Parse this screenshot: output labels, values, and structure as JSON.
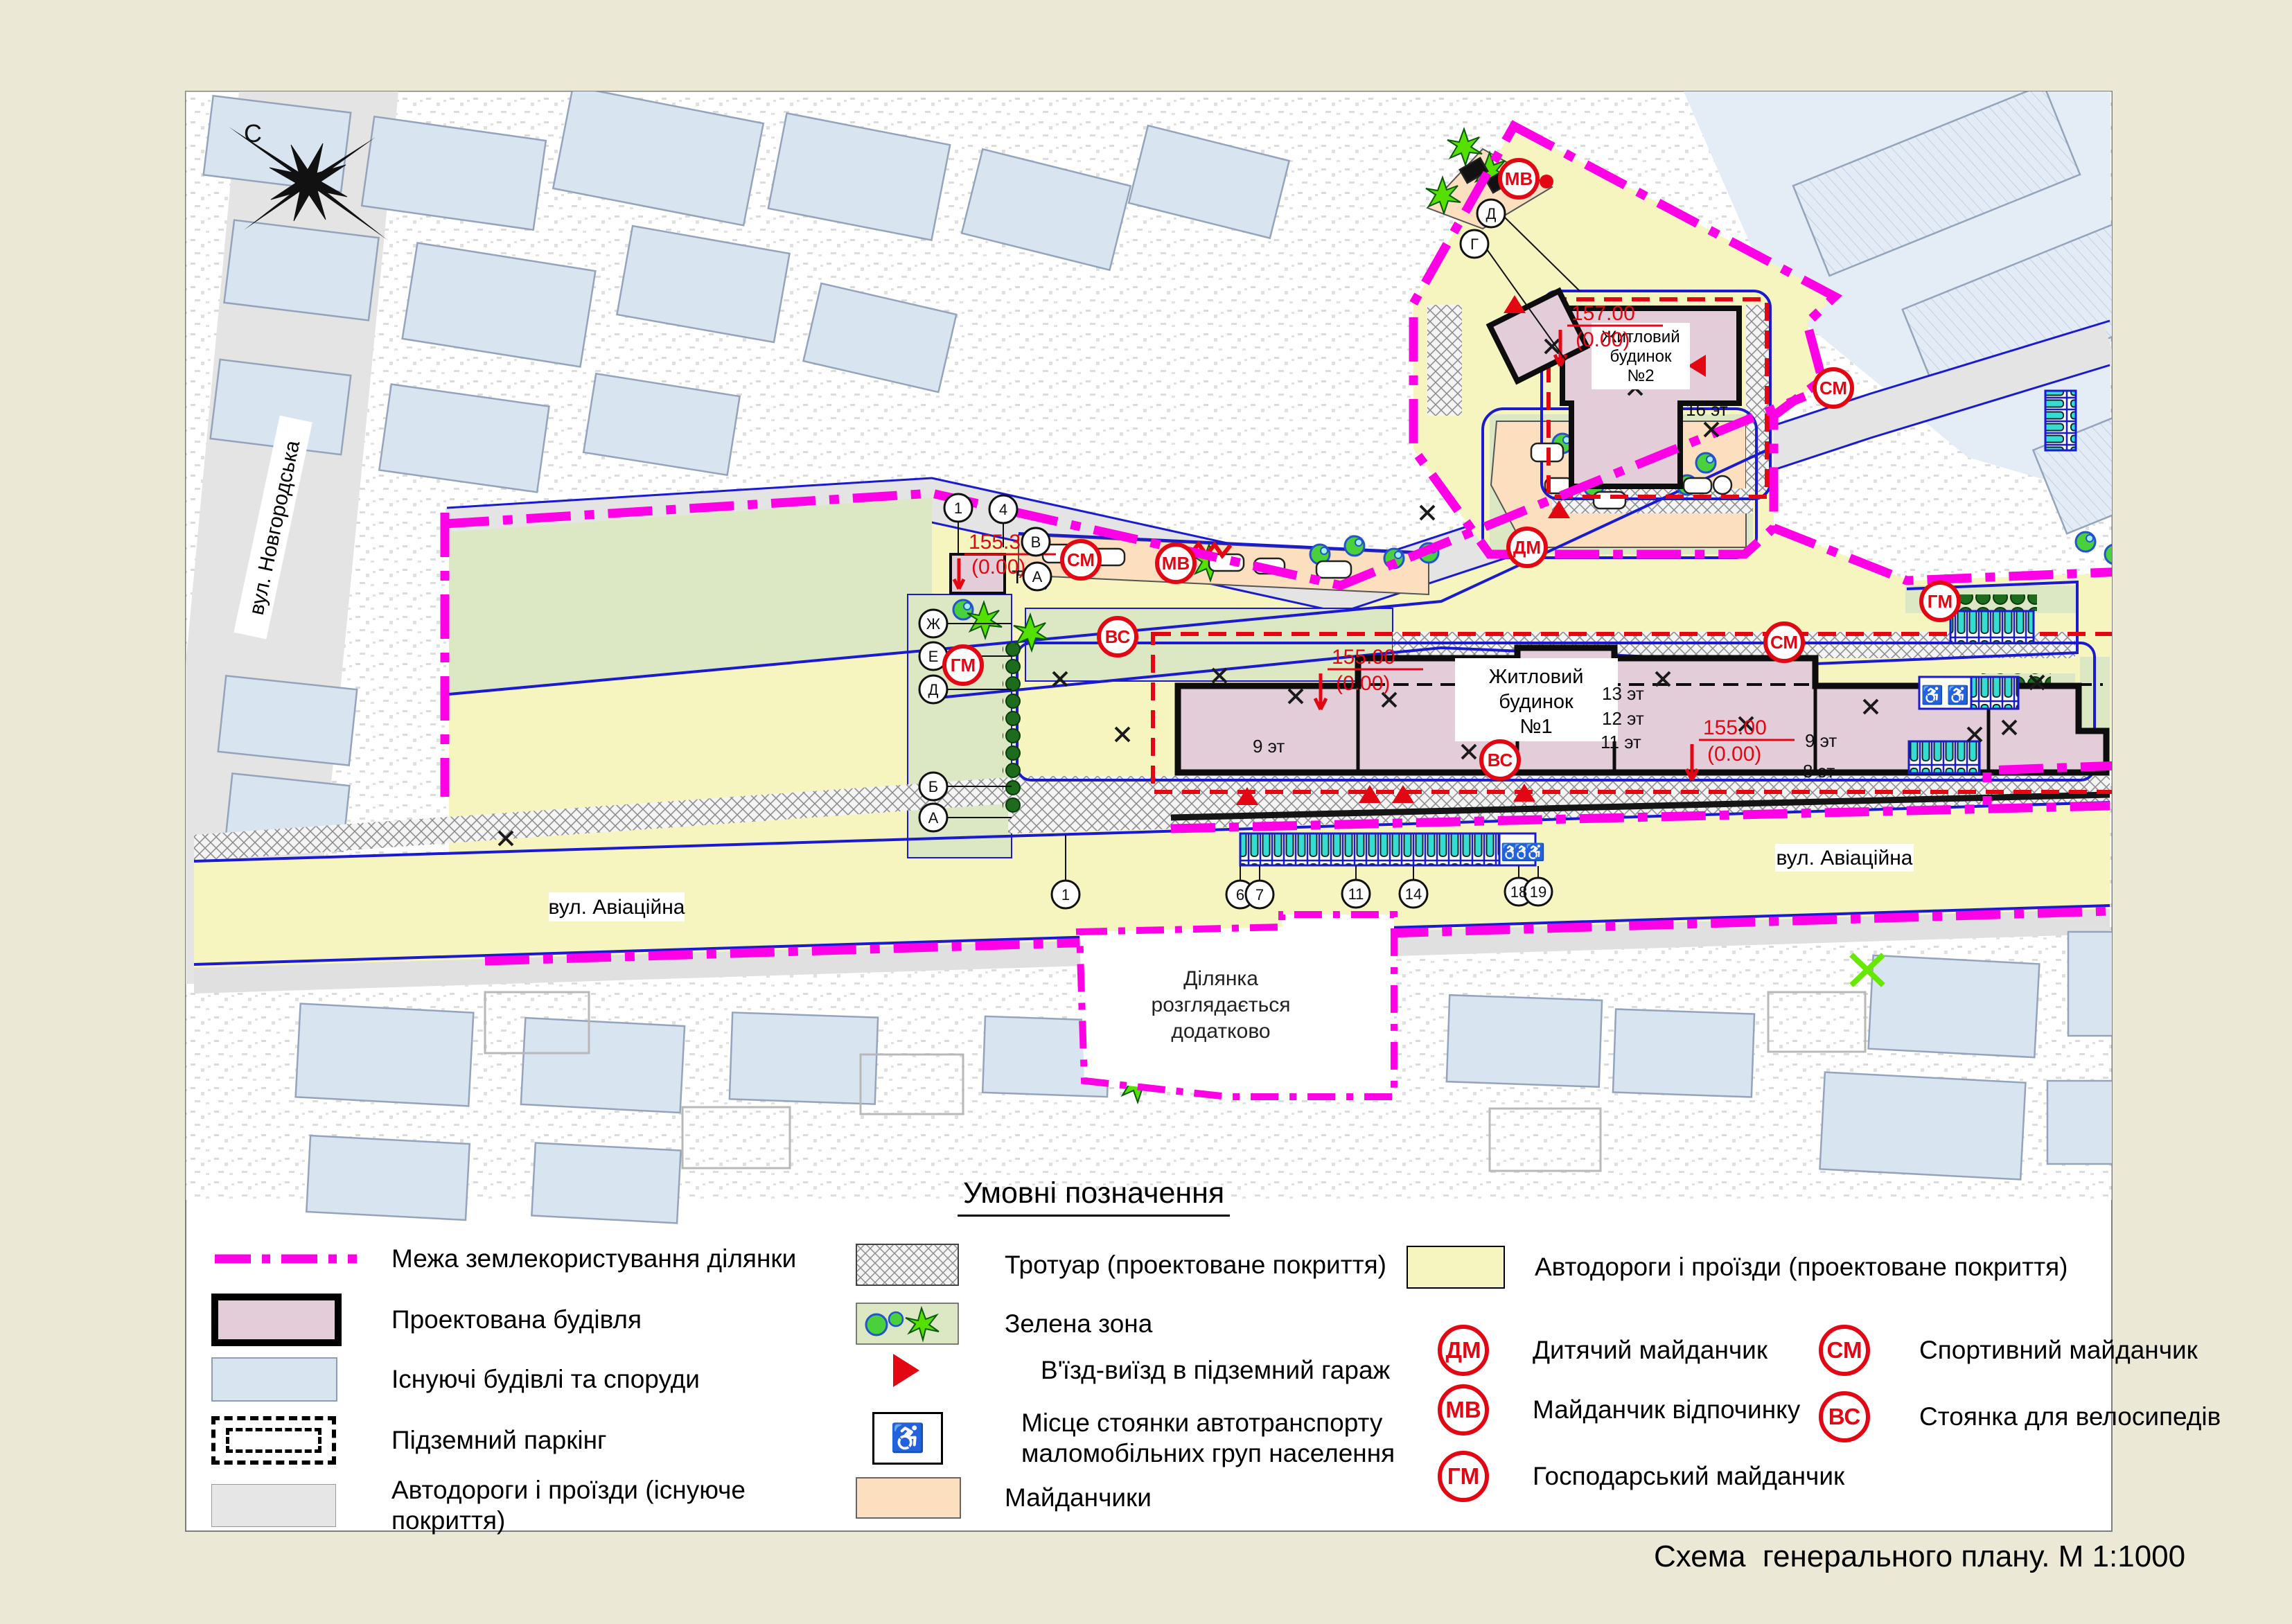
{
  "compass": {
    "north": "С"
  },
  "icons": {
    "wheelchair": "♿"
  },
  "map": {
    "streets": {
      "novhorodska": "вул. Новгородська",
      "aviatsiina_west": "вул. Авіаційна",
      "aviatsiina_east": "вул. Авіаційна"
    },
    "building1": {
      "l1": "Житловий",
      "l2": "будинок",
      "l3": "№1"
    },
    "building2": {
      "l1": "Житловий",
      "l2": "будинок",
      "l3": "№2"
    },
    "tp_label": "ТП",
    "site_note": {
      "l1": "Ділянка",
      "l2": "розглядається",
      "l3": "додатково"
    },
    "elevations": [
      {
        "value": "157.00",
        "zero": "(0.00)"
      },
      {
        "value": "155.00",
        "zero": "(0.00)"
      },
      {
        "value": "155.00",
        "zero": "(0.00)"
      },
      {
        "value": "155.30",
        "zero": "(0.00)"
      }
    ],
    "floors": [
      "16 эт",
      "13 эт",
      "12 эт",
      "11 эт",
      "9 эт",
      "8 эт",
      "9 эт"
    ],
    "axes_west": [
      "Ж",
      "Е",
      "Д",
      "Б",
      "А"
    ],
    "axes_street": [
      "1",
      "6",
      "7",
      "11",
      "14",
      "18",
      "19"
    ],
    "axes_wedge": [
      "1",
      "4",
      "В",
      "А"
    ],
    "axes_top": [
      "Д",
      "Г"
    ],
    "plan_badges": [
      "МВ",
      "СМ",
      "ДМ",
      "СМ",
      "МВ",
      "ВС",
      "ГМ",
      "ВС",
      "СМ",
      "ГМ"
    ]
  },
  "legend": {
    "title": "Умовні позначення",
    "col1": [
      "Межа землекористування ділянки",
      "Проектована будівля",
      "Існуючі будівлі та споруди",
      "Підземний паркінг",
      "Автодороги і проїзди (існуюче покриття)"
    ],
    "col2": [
      "Тротуар (проектоване покриття)",
      "Зелена зона",
      "В'їзд-виїзд в підземний гараж",
      "Місце стоянки автотранспорту маломобільних груп населення",
      "Майданчики"
    ],
    "col3_road": "Автодороги і проїзди (проектоване покриття)",
    "col3_badges": [
      {
        "code": "ДМ",
        "label": "Дитячий майданчик"
      },
      {
        "code": "МВ",
        "label": "Майданчик відпочинку"
      },
      {
        "code": "ГМ",
        "label": "Господарський майданчик"
      },
      {
        "code": "СМ",
        "label": "Спортивний майданчик"
      },
      {
        "code": "ВС",
        "label": "Стоянка для велосипедів"
      }
    ]
  },
  "caption": "Схема  генерального плану. М 1:1000"
}
